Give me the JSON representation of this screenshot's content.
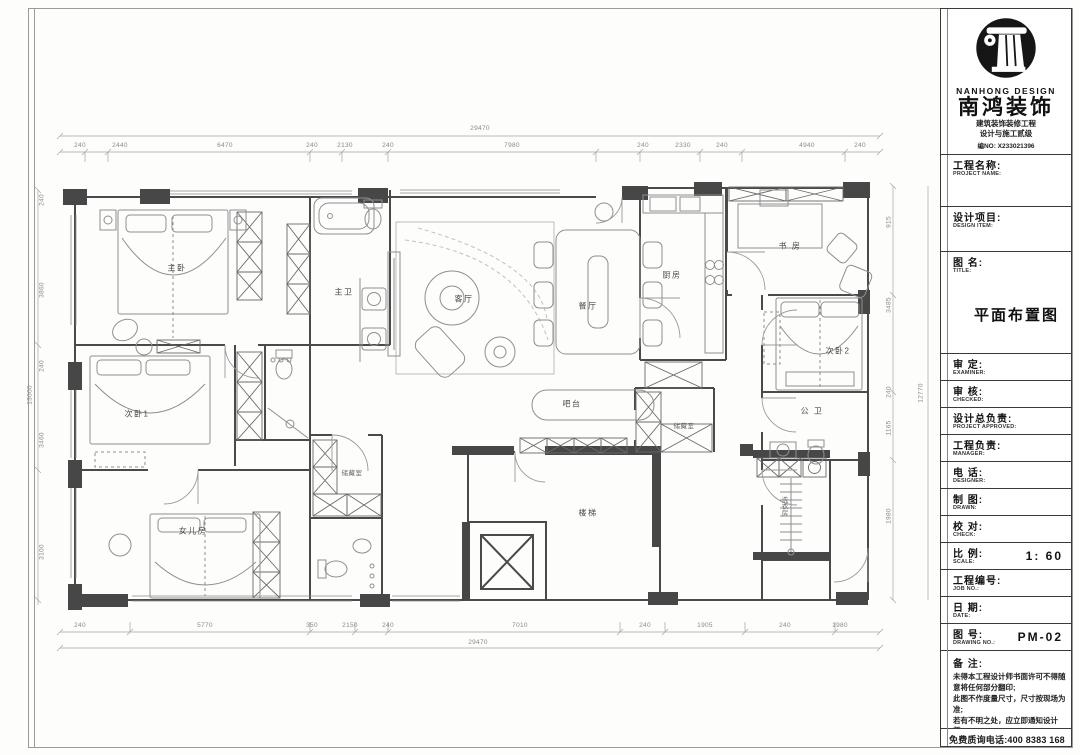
{
  "title_block": {
    "brand_en": "NANHONG DESIGN",
    "brand_cn": "南鸿装饰",
    "cert_line1": "建筑装饰装修工程",
    "cert_line2": "设计与施工贰级",
    "cert_no": "编NO: X233021396",
    "rows": [
      {
        "cn": "工程名称:",
        "en": "PROJECT NAME:",
        "value": "",
        "h": 52
      },
      {
        "cn": "设计项目:",
        "en": "DESIGN ITEM:",
        "value": "",
        "h": 45
      },
      {
        "cn": "图  名:",
        "en": "TITLE:",
        "value": "平面布置图",
        "h": 102,
        "big": true
      },
      {
        "cn": "审  定:",
        "en": "EXAMINER:",
        "value": "",
        "h": 27
      },
      {
        "cn": "审  核:",
        "en": "CHECKED:",
        "value": "",
        "h": 27
      },
      {
        "cn": "设计总负责:",
        "en": "PROJECT APPROVED:",
        "value": "",
        "h": 27
      },
      {
        "cn": "工程负责:",
        "en": "MANAGER:",
        "value": "",
        "h": 27
      },
      {
        "cn": "电  话:",
        "en": "DESIGNER:",
        "value": "",
        "h": 27
      },
      {
        "cn": "制  图:",
        "en": "DRAWN:",
        "value": "",
        "h": 27
      },
      {
        "cn": "校  对:",
        "en": "CHECK:",
        "value": "",
        "h": 27
      },
      {
        "cn": "比  例:",
        "en": "SCALE:",
        "value": "1: 60",
        "h": 27
      },
      {
        "cn": "工程编号:",
        "en": "JOB NO.:",
        "value": "",
        "h": 27
      },
      {
        "cn": "日  期:",
        "en": "DATE:",
        "value": "",
        "h": 27
      },
      {
        "cn": "图  号:",
        "en": "DRAWING NO.:",
        "value": "PM-02",
        "h": 27
      }
    ],
    "notes_label": "备 注:",
    "notes": [
      "未得本工程设计师书面许可不得随意将任何部分翻印;",
      "此图不作度量尺寸，尺寸按现场为准;",
      "若有不明之处，应立即通知设计师。"
    ],
    "notes_fine": "本设计版权归南鸿装饰设计师所有。",
    "hotline": "免费质询电话:400 8383 168"
  },
  "plan": {
    "drawing_title": "平面布置图",
    "rooms": [
      {
        "name": "主卧",
        "x": 177,
        "y": 268
      },
      {
        "name": "主卫",
        "x": 344,
        "y": 292
      },
      {
        "name": "客厅",
        "x": 464,
        "y": 299
      },
      {
        "name": "餐厅",
        "x": 588,
        "y": 306
      },
      {
        "name": "厨房",
        "x": 672,
        "y": 275
      },
      {
        "name": "书 房",
        "x": 790,
        "y": 246
      },
      {
        "name": "次卧2",
        "x": 838,
        "y": 351
      },
      {
        "name": "公 卫",
        "x": 812,
        "y": 411
      },
      {
        "name": "次卧1",
        "x": 137,
        "y": 414
      },
      {
        "name": "女儿房",
        "x": 193,
        "y": 531
      },
      {
        "name": "储藏室",
        "x": 352,
        "y": 472,
        "small": true
      },
      {
        "name": "储藏室",
        "x": 684,
        "y": 425,
        "small": true
      },
      {
        "name": "楼梯",
        "x": 588,
        "y": 513
      },
      {
        "name": "吧台",
        "x": 572,
        "y": 404
      },
      {
        "name": "洗衣房",
        "x": 783,
        "y": 506,
        "small": true,
        "vert": true
      }
    ],
    "h_dims": [
      {
        "t": "29470",
        "x": 480,
        "y": 132
      },
      {
        "t": "240",
        "x": 80,
        "y": 149
      },
      {
        "t": "2440",
        "x": 120,
        "y": 149
      },
      {
        "t": "6470",
        "x": 225,
        "y": 149
      },
      {
        "t": "240",
        "x": 312,
        "y": 149
      },
      {
        "t": "2130",
        "x": 345,
        "y": 149
      },
      {
        "t": "240",
        "x": 388,
        "y": 149
      },
      {
        "t": "7980",
        "x": 512,
        "y": 149
      },
      {
        "t": "240",
        "x": 643,
        "y": 149
      },
      {
        "t": "2330",
        "x": 683,
        "y": 149
      },
      {
        "t": "240",
        "x": 722,
        "y": 149
      },
      {
        "t": "4940",
        "x": 807,
        "y": 149
      },
      {
        "t": "240",
        "x": 860,
        "y": 149
      },
      {
        "t": "240",
        "x": 80,
        "y": 629
      },
      {
        "t": "5770",
        "x": 205,
        "y": 629
      },
      {
        "t": "350",
        "x": 312,
        "y": 629
      },
      {
        "t": "2150",
        "x": 350,
        "y": 629
      },
      {
        "t": "240",
        "x": 388,
        "y": 629
      },
      {
        "t": "7010",
        "x": 520,
        "y": 629
      },
      {
        "t": "240",
        "x": 645,
        "y": 629
      },
      {
        "t": "1905",
        "x": 705,
        "y": 629
      },
      {
        "t": "240",
        "x": 785,
        "y": 629
      },
      {
        "t": "1980",
        "x": 840,
        "y": 629
      },
      {
        "t": "29470",
        "x": 478,
        "y": 646
      }
    ],
    "v_dims": [
      {
        "t": "13000",
        "x": 30,
        "y": 395
      },
      {
        "t": "240",
        "x": 42,
        "y": 200
      },
      {
        "t": "3860",
        "x": 42,
        "y": 290
      },
      {
        "t": "240",
        "x": 42,
        "y": 366
      },
      {
        "t": "3460",
        "x": 42,
        "y": 440
      },
      {
        "t": "3100",
        "x": 42,
        "y": 552
      },
      {
        "t": "915",
        "x": 889,
        "y": 222
      },
      {
        "t": "3485",
        "x": 889,
        "y": 305
      },
      {
        "t": "240",
        "x": 889,
        "y": 392
      },
      {
        "t": "1165",
        "x": 889,
        "y": 428
      },
      {
        "t": "1980",
        "x": 889,
        "y": 516
      },
      {
        "t": "12770",
        "x": 921,
        "y": 393
      }
    ]
  }
}
